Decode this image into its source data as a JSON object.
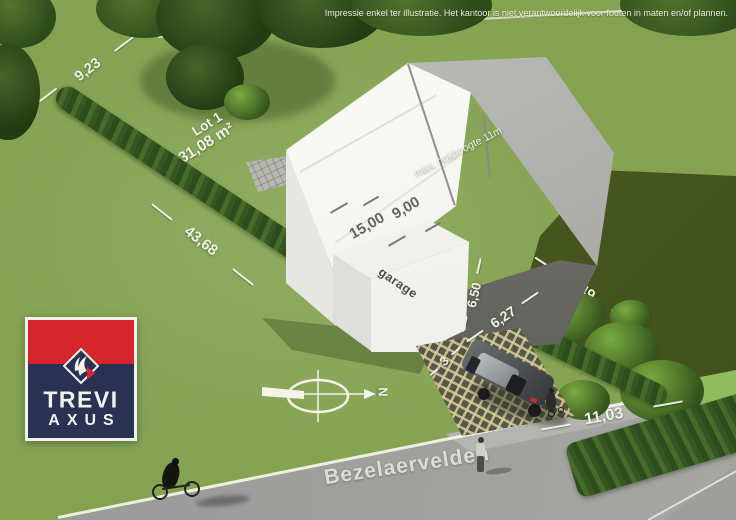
{
  "disclaimer": "Impressie enkel ter illustratie. Het kantoor is niet verantwoordelijk voor fouten in maten en/of plannen.",
  "plot": {
    "lot_name": "Lot 1",
    "lot_area": "431,08 m²",
    "street_name": "Bezelaervelden"
  },
  "building": {
    "roof_note": "max. nokhoogte 11m",
    "garage_label": "garage"
  },
  "measurements": {
    "rear_width": "9,23",
    "left_boundary": "43,68",
    "house_length": "15,00",
    "house_width": "9,00",
    "side_wall": "6,50",
    "front_garden_depth": "6,27",
    "driveway_width": "3",
    "right_boundary": "49,49",
    "street_frontage": "11,03"
  },
  "compass": {
    "north": "N"
  },
  "logo": {
    "line1": "TREVI",
    "line2": "AXUS"
  },
  "colors": {
    "grass": "#8ab457",
    "grass_dark": "#48571f",
    "hedge": "#33511f",
    "road": "#9b9b97",
    "roof_gray": "#b0b0ac",
    "wall_white": "#f4f4f0",
    "logo_red": "#d5242b",
    "logo_navy": "#2b3153"
  }
}
